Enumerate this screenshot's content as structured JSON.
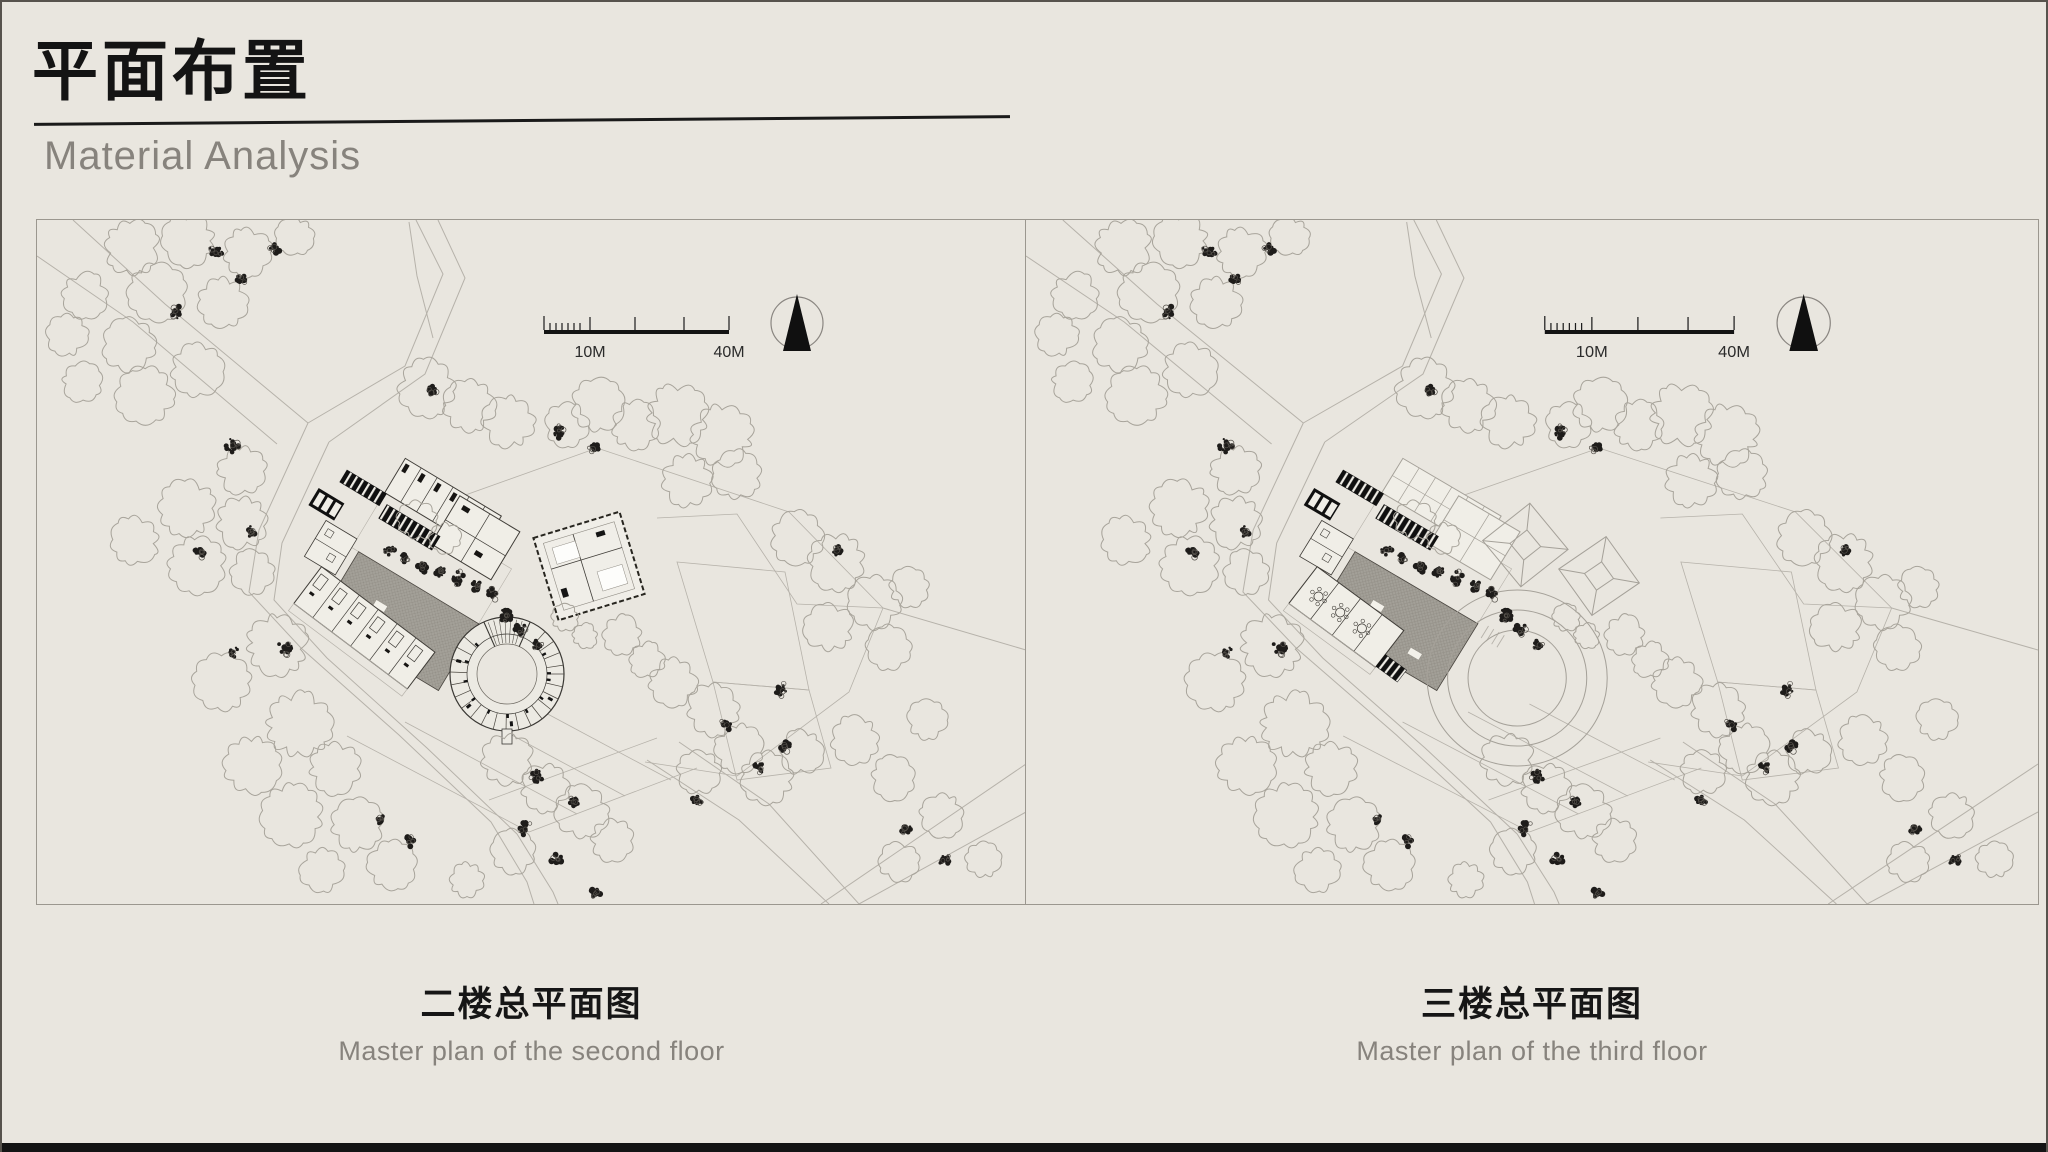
{
  "header": {
    "title": "平面布置",
    "subtitle": "Material Analysis"
  },
  "panels": [
    {
      "caption_zh": "二楼总平面图",
      "caption_en": "Master plan of the second floor",
      "scale_10": "10M",
      "scale_40": "40M"
    },
    {
      "caption_zh": "三楼总平面图",
      "caption_en": "Master plan of the third floor",
      "scale_10": "10M",
      "scale_40": "40M"
    }
  ],
  "colors": {
    "background": "#e9e6df",
    "ink": "#141414",
    "subtitle_gray": "#87837d",
    "road_gray": "#b6b2aa",
    "tree_gray": "#a8a49b",
    "building_ink": "#3f3c37",
    "courtyard_gray": "#a3a098",
    "panel_border": "#9b978f",
    "bottom_bar": "#141414"
  }
}
